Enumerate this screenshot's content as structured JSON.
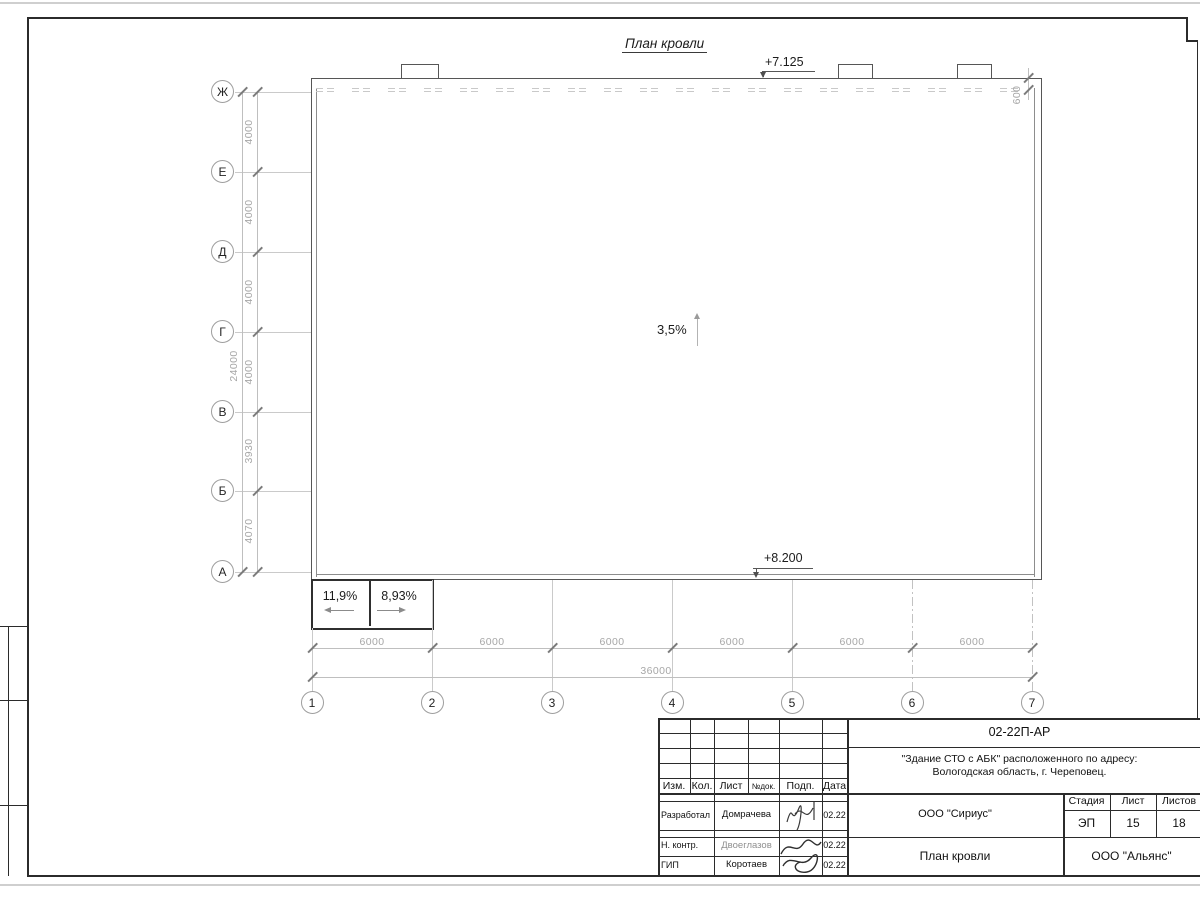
{
  "drawing": {
    "title": "План кровли",
    "elevation_top": "+7.125",
    "elevation_bottom": "+8.200",
    "slope_main": "3,5%",
    "slope_annex_left": "11,9%",
    "slope_annex_right": "8,93%",
    "parapet_offset_dim": "600",
    "row_axes": [
      "Ж",
      "Е",
      "Д",
      "Г",
      "В",
      "Б",
      "А"
    ],
    "row_dims": [
      "4000",
      "4000",
      "4000",
      "4000",
      "3930",
      "4070"
    ],
    "row_total_dim": "24000",
    "col_axes": [
      "1",
      "2",
      "3",
      "4",
      "5",
      "6",
      "7"
    ],
    "col_dims": [
      "6000",
      "6000",
      "6000",
      "6000",
      "6000",
      "6000"
    ],
    "col_total_dim": "36000"
  },
  "title_block": {
    "doc_number": "02-22П-АР",
    "project_line1": "\"Здание СТО с АБК\" расположенного по адресу:",
    "project_line2": "Вологодская область, г. Череповец.",
    "col_izm": "Изм.",
    "col_kol": "Кол.",
    "col_list": "Лист",
    "col_ndok": "№док.",
    "col_podp": "Подп.",
    "col_data": "Дата",
    "staff": [
      {
        "role": "Разработал",
        "name": "Домрачева",
        "date": "02.22"
      },
      {
        "role": "Н. контр.",
        "name": "Двоеглазов",
        "date": "02.22"
      },
      {
        "role": "ГИП",
        "name": "Коротаев",
        "date": "02.22"
      }
    ],
    "designer_org": "ООО \"Сириус\"",
    "client_org": "ООО \"Альянс\"",
    "sheet_title": "План кровли",
    "stage_label": "Стадия",
    "list_label": "Лист",
    "listov_label": "Листов",
    "stage_value": "ЭП",
    "list_value": "15",
    "listov_value": "18"
  }
}
